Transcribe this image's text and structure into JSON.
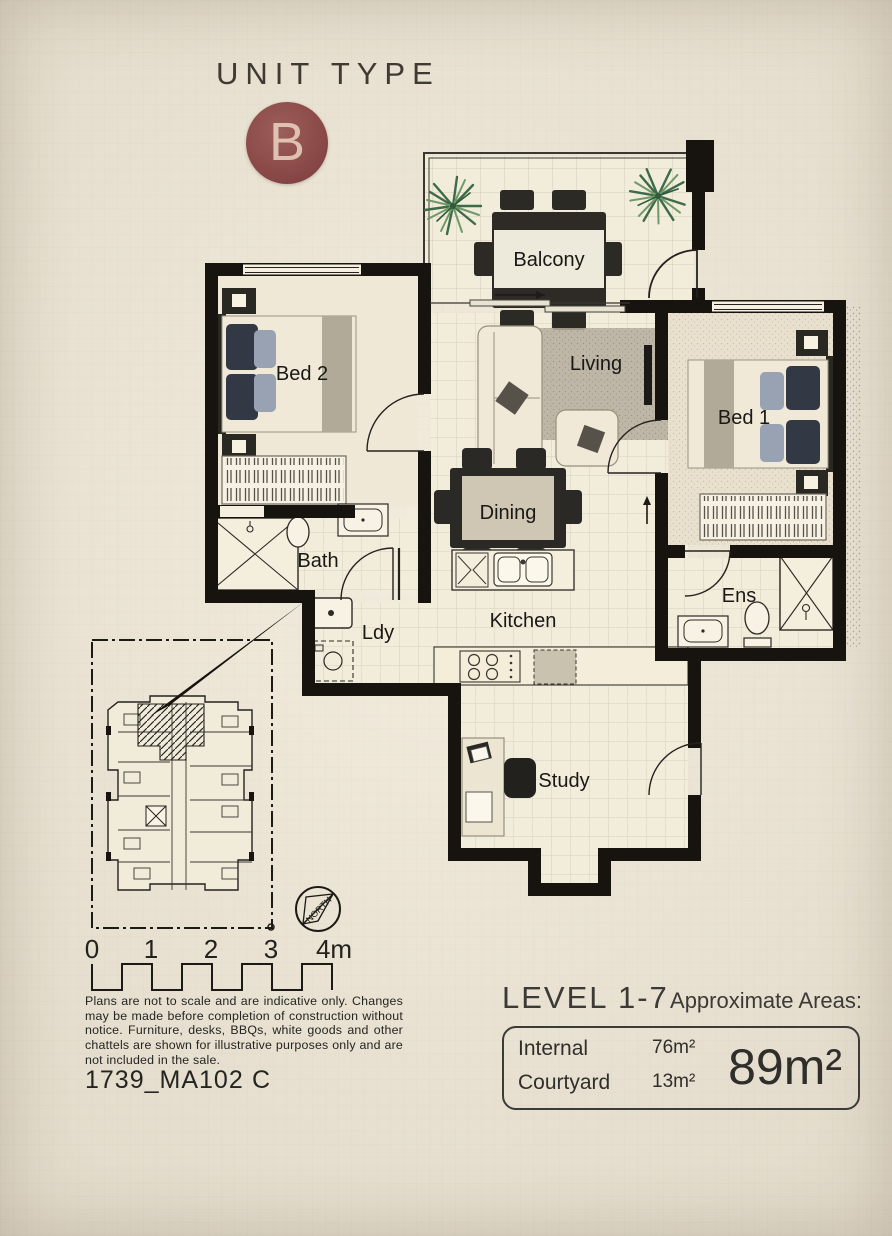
{
  "page": {
    "background": "#ebe4d2",
    "wall_color": "#17140f"
  },
  "header": {
    "title": "UNIT TYPE",
    "badge_letter": "B",
    "badge_color": "#8c4b49"
  },
  "rooms": {
    "balcony": "Balcony",
    "bed2": "Bed 2",
    "living": "Living",
    "bed1": "Bed 1",
    "dining": "Dining",
    "bath": "Bath",
    "ldy": "Ldy",
    "kitchen": "Kitchen",
    "ens": "Ens",
    "study": "Study"
  },
  "compass": {
    "north_label": "NORTH"
  },
  "scale_bar": {
    "ticks": [
      "0",
      "1",
      "2",
      "3",
      "4m"
    ]
  },
  "notes": {
    "disclaimer": "Plans are not to scale and are indicative only. Changes may be made before completion of construction without notice. Furniture, desks, BBQs, white goods and other chattels are shown for illustrative purposes only and are not included in the sale."
  },
  "footer": {
    "doc_number": "1739_MA102",
    "revision": "C"
  },
  "areas": {
    "level_label": "LEVEL 1-7",
    "heading": "Approximate Areas:",
    "rows": [
      {
        "label": "Internal",
        "value": "76m²"
      },
      {
        "label": "Courtyard",
        "value": "13m²"
      }
    ],
    "total": "89m²"
  }
}
